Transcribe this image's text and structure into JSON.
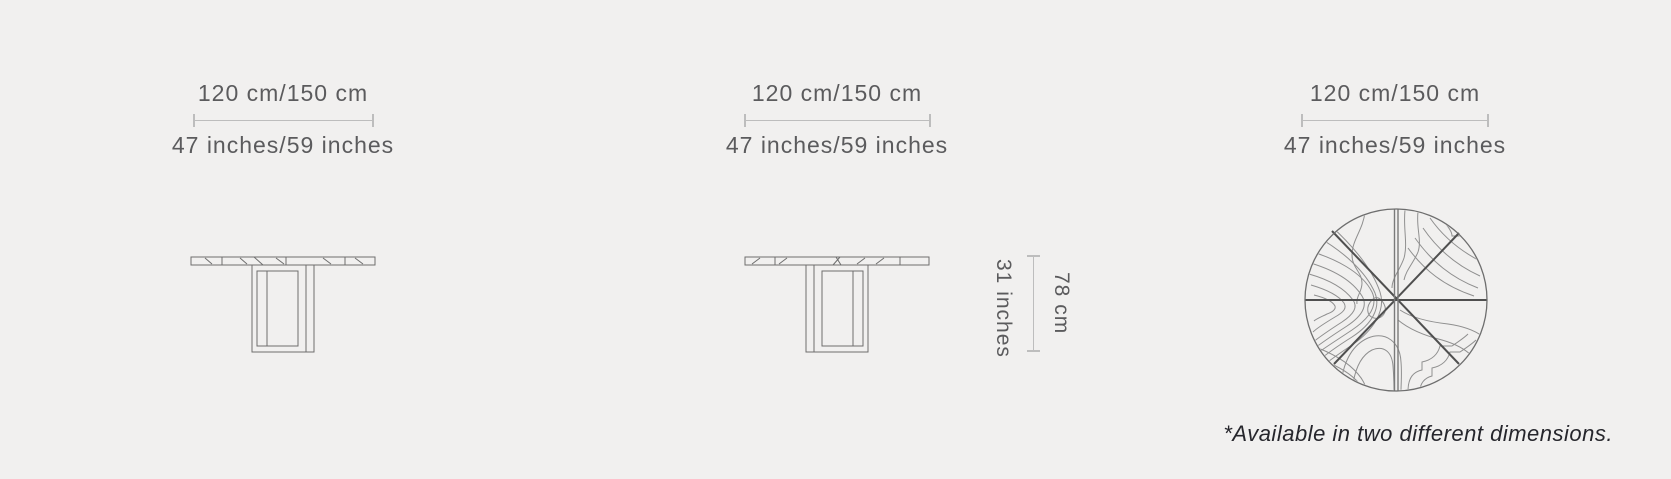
{
  "colors": {
    "background": "#f1f0ef",
    "dimension_line": "#bdbdbd",
    "label_text": "#5b5b5d",
    "drawing_line": "#6e6e6e",
    "spoke_line": "#4f4f4f",
    "grain_line": "#8f8f8f",
    "footnote_text": "#26262c"
  },
  "views": {
    "side_left": {
      "width_metric": "120 cm/150 cm",
      "width_imperial": "47 inches/59 inches"
    },
    "side_center": {
      "width_metric": "120 cm/150 cm",
      "width_imperial": "47 inches/59 inches",
      "height_imperial": "31 inches",
      "height_metric": "78 cm"
    },
    "top": {
      "width_metric": "120 cm/150 cm",
      "width_imperial": "47 inches/59 inches"
    }
  },
  "footnote": "*Available in two different dimensions."
}
